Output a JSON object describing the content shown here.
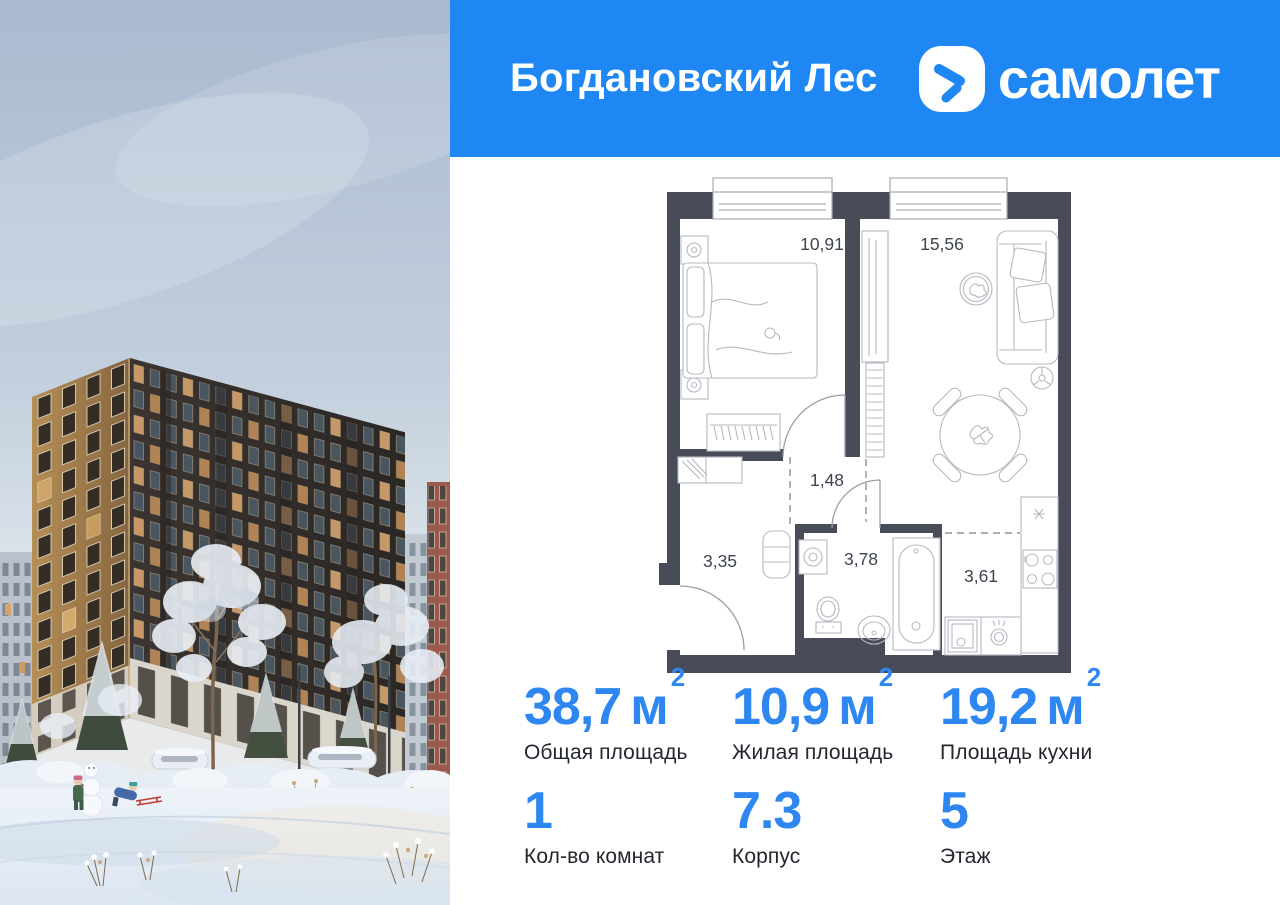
{
  "header": {
    "project_name": "Богдановский Лес",
    "brand_name": "самолет",
    "background_color": "#1e87f3"
  },
  "floor_plan": {
    "wall_color": "#474c58",
    "rooms": [
      {
        "id": "bedroom",
        "area": "10,91"
      },
      {
        "id": "living-kitchen",
        "area": "15,56"
      },
      {
        "id": "corridor",
        "area": "1,48"
      },
      {
        "id": "hallway",
        "area": "3,35"
      },
      {
        "id": "bathroom",
        "area": "3,78"
      },
      {
        "id": "kitchen-zone",
        "area": "3,61"
      }
    ]
  },
  "stats": {
    "accent_color": "#2e87f0",
    "items": [
      {
        "value": "38,7",
        "unit": "м",
        "unit_sup": "2",
        "label": "Общая площадь"
      },
      {
        "value": "10,9",
        "unit": "м",
        "unit_sup": "2",
        "label": "Жилая площадь"
      },
      {
        "value": "19,2",
        "unit": "м",
        "unit_sup": "2",
        "label": "Площадь кухни"
      },
      {
        "value": "1",
        "label": "Кол-во комнат"
      },
      {
        "value": "7.3",
        "label": "Корпус"
      },
      {
        "value": "5",
        "label": "Этаж"
      }
    ]
  }
}
